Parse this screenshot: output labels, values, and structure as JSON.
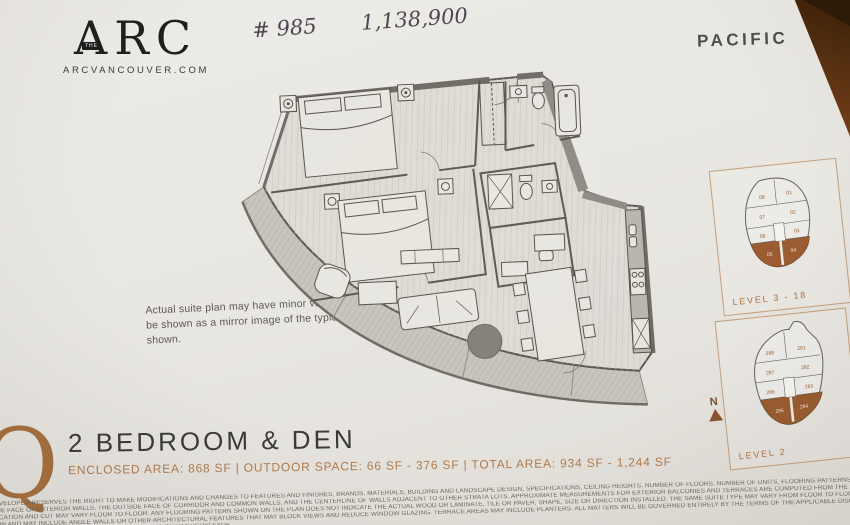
{
  "colors": {
    "accent_copper": "#a5703f",
    "highlight_unit": "#9a5c30",
    "text_dark": "#3b3a38",
    "paper": "#e9e7e2",
    "wood_table": "#8a4a1e"
  },
  "header": {
    "logo": {
      "the": "THE",
      "name": "ARC",
      "website": "ARCVANCOUVER.COM"
    },
    "handwritten": {
      "unit_number": "# 985",
      "price": "1,138,900"
    },
    "collection": "PACIFIC"
  },
  "note": {
    "line1": "Actual suite plan may have minor variations from or",
    "line2": "be shown as a mirror image of the typical plan shown."
  },
  "keyplans": [
    {
      "label": "LEVEL 3 - 18",
      "units": [
        "08",
        "01",
        "07",
        "02",
        "06",
        "03",
        "05",
        "04"
      ],
      "highlighted_units": "05, 04"
    },
    {
      "label": "LEVEL 2",
      "units": [
        "288",
        "281",
        "287",
        "282",
        "286",
        "283",
        "285",
        "284"
      ],
      "highlighted_units": "285, 284"
    }
  ],
  "north": {
    "label": "N"
  },
  "suite": {
    "plan_letter": "Q",
    "title": "2 BEDROOM & DEN",
    "areas": "ENCLOSED AREA: 868 SF  |  OUTDOOR SPACE: 66 SF - 376 SF  |  TOTAL AREA: 934 SF - 1,244 SF"
  },
  "disclaimer": {
    "lines": [
      "DEVELOPER RESERVES THE RIGHT TO MAKE MODIFICATIONS AND CHANGES TO FEATURES AND FINISHES, BRANDS, MATERIALS, BUILDING AND LANDSCAPE DESIGN, SPECIFICATIONS, CEILING HEIGHTS, NUMBER OF FLOORS, NUMBER OF UNITS, FLOORING PATTERNS AND FLOOR PLANS WITHOUT NOTIFICATION. APPROXIMATE SUITE SIZES ARE COM",
      "SIDE FACE OF EXTERIOR WALLS, THE OUTSIDE FACE OF CORRIDOR AND COMMON WALLS, AND THE CENTERLINE OF WALLS ADJACENT TO OTHER STRATA LOTS. APPROXIMATE MEASUREMENTS FOR EXTERIOR BALCONIES AND TERRACES ARE COMPUTED FROM THE OUTSIDE FACE OF EXTERIOR WALLS TO THE SLAB EDGES OF THE OUTSIDE FACE O",
      "LOCATION AND CUT MAY VARY FLOOR TO FLOOR. ANY FLOORING PATTERN SHOWN ON THE PLAN DOES NOT INDICATE THE ACTUAL WOOD OR LAMINATE, TILE OR PAVER, SHAPE, SIZE OR DIRECTION INSTALLED. THE SAME SUITE TYPE MAY VARY FROM FLOOR TO FLOOR AND/OR BE SLIGHTLY ALTERED DEPENDING ON FLOOR PLATE ORIENTAT",
      "TION AND MAY INCLUDE ANGLE WALLS OR OTHER ARCHITECTURAL FEATURES THAT MAY BLOCK VIEWS AND REDUCE WINDOW GLAZING. TERRACE AREAS MAY INCLUDE PLANTERS. ALL MATTERS WILL BE GOVERNED ENTIRELY BY THE TERMS OF THE APPLICABLE DISCLOSURE STATEMENT",
      "NT OF PURCHASE AND SALE. CONCORD ARC LIMITED PARTNERSHIP E&OE."
    ]
  }
}
